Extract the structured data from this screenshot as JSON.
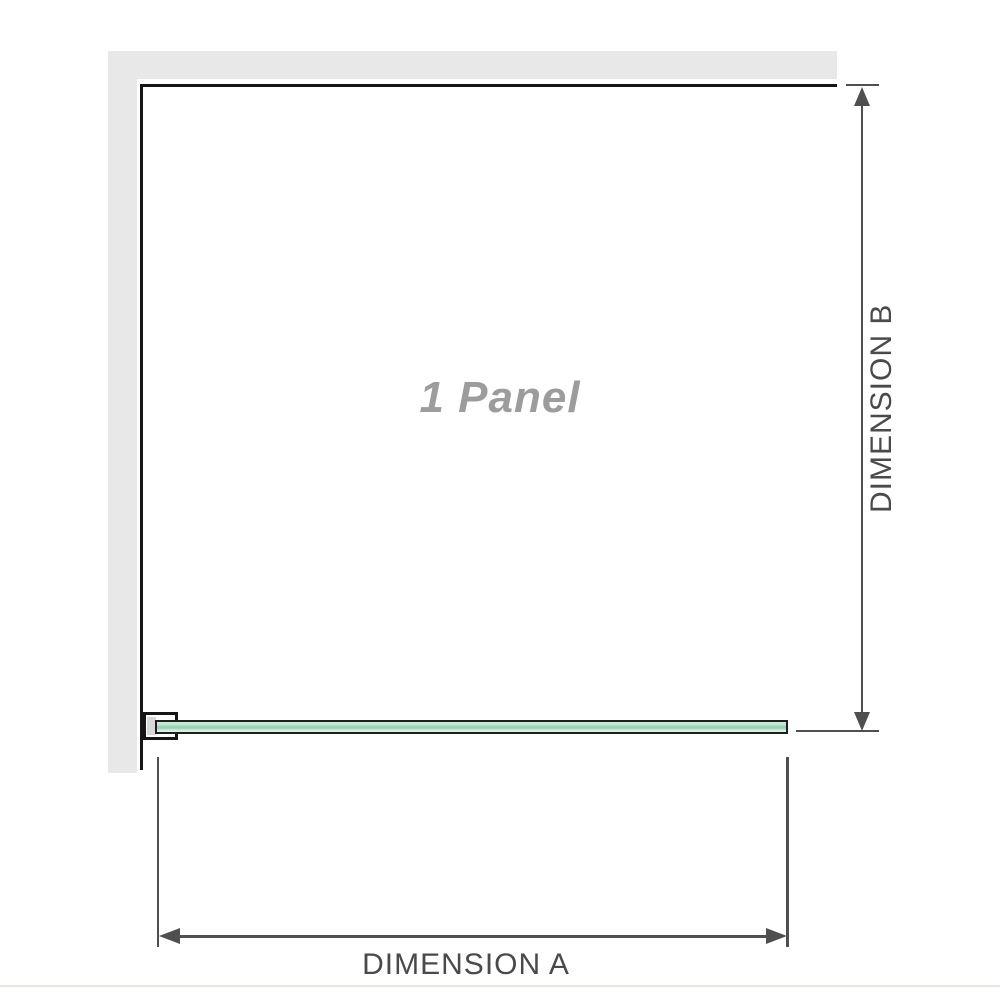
{
  "diagram": {
    "panel_label": "1 Panel",
    "dimension_vertical": {
      "label": "DIMENSION B"
    },
    "dimension_horizontal": {
      "label": "DIMENSION A"
    }
  },
  "icons": {
    "dimension_b_top": "arrow-up",
    "dimension_b_bottom": "arrow-down",
    "dimension_a_left": "arrow-left",
    "dimension_a_right": "arrow-right"
  },
  "colors": {
    "background": "#ffffff",
    "wall_fill": "#e8e8e8",
    "structure_line": "#161616",
    "dimension_line": "#4f4f4f",
    "dimension_text": "#4a4a4a",
    "panel_label_text": "#9c9c9c",
    "glass_border": "#1f1f1f",
    "glass_light": "#dff2e7",
    "glass_mid": "#97d2b4",
    "bracket_pad": "#d8d8d8",
    "baseline": "#e9e6e2"
  }
}
